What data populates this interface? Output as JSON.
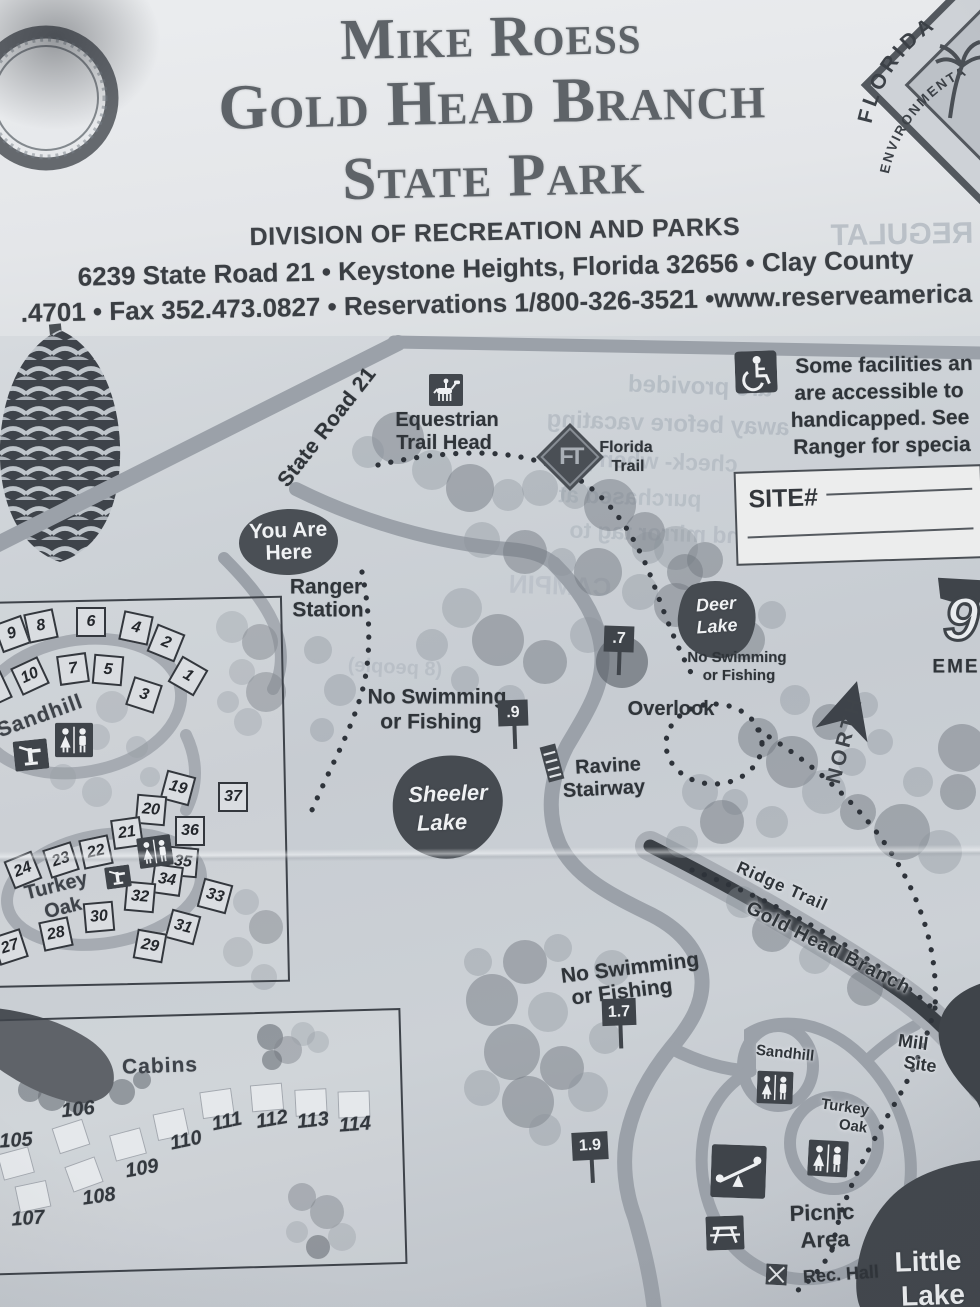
{
  "header": {
    "title_line1": "Mike Roess",
    "title_line2": "Gold Head Branch",
    "title_line3": "State Park",
    "division": "DIVISION OF RECREATION AND PARKS",
    "address_line": "6239 State Road 21 • Keystone Heights, Florida  32656 • Clay County",
    "contact_line": ".4701 • Fax 352.473.0827 • Reservations 1/800-326-3521 •www.reserveamerica"
  },
  "badge": {
    "arc_top": "FLORIDA",
    "arc_bottom": "ENVIRONMENTA"
  },
  "accessibility": {
    "lines": [
      "Some facilities an",
      "are accessible to",
      "handicapped. See",
      "Ranger for specia"
    ]
  },
  "site_box": {
    "label": "SITE#"
  },
  "map": {
    "state_road": "State Road 21",
    "equestrian_line1": "Equestrian",
    "equestrian_line2": "Trail Head",
    "florida_trail_monogram": "FT",
    "florida_trail_line1": "Florida",
    "florida_trail_line2": "Trail",
    "you_are_here_line1": "You Are",
    "you_are_here_line2": "Here",
    "ranger_line1": "Ranger",
    "ranger_line2": "Station",
    "deer_lake_line1": "Deer",
    "deer_lake_line2": "Lake",
    "no_swim_line1": "No Swimming",
    "no_swim_line2": "or Fishing",
    "marker_07": ".7",
    "marker_09": ".9",
    "marker_17": "1.7",
    "marker_19": "1.9",
    "overlook": "Overlook",
    "ravine_line1": "Ravine",
    "ravine_line2": "Stairway",
    "sheeler_line1": "Sheeler",
    "sheeler_line2": "Lake",
    "north": "NORTH",
    "emergency_number": "9",
    "emergency_text": "EME",
    "ridge_trail": "Ridge Trail",
    "gold_head_branch": "Gold Head Branch",
    "mill_line1": "Mill",
    "mill_line2": "Site",
    "sandhill_south": "Sandhill",
    "turkey_line1": "Turkey",
    "turkey_line2": "Oak",
    "picnic_line1": "Picnic",
    "picnic_line2": "Area",
    "rec_hall": "Rec. Hall",
    "little_line1": "Little",
    "little_line2": "Lake"
  },
  "campground": {
    "sandhill_label": "Sandhill",
    "turkey_label_line1": "Turkey",
    "turkey_label_line2": "Oak",
    "sandhill_sites": [
      "9",
      "8",
      "6",
      "4",
      "2",
      "10",
      "7",
      "5",
      "3",
      "1",
      "2"
    ],
    "turkey_sites": [
      "19",
      "20",
      "37",
      "36",
      "21",
      "22",
      "23",
      "24",
      "35",
      "34",
      "33",
      "32",
      "31",
      "30",
      "28",
      "29",
      "27"
    ]
  },
  "cabins": {
    "label": "Cabins",
    "numbers": [
      "105",
      "106",
      "107",
      "108",
      "109",
      "110",
      "111",
      "112",
      "113",
      "114"
    ]
  },
  "bleedthrough": [
    "REGULAT",
    "are provided",
    "away before vacating",
    "check- when you",
    "purchased at",
    "nd mirror tag to",
    "(8 people)",
    "CAMPIN"
  ]
}
